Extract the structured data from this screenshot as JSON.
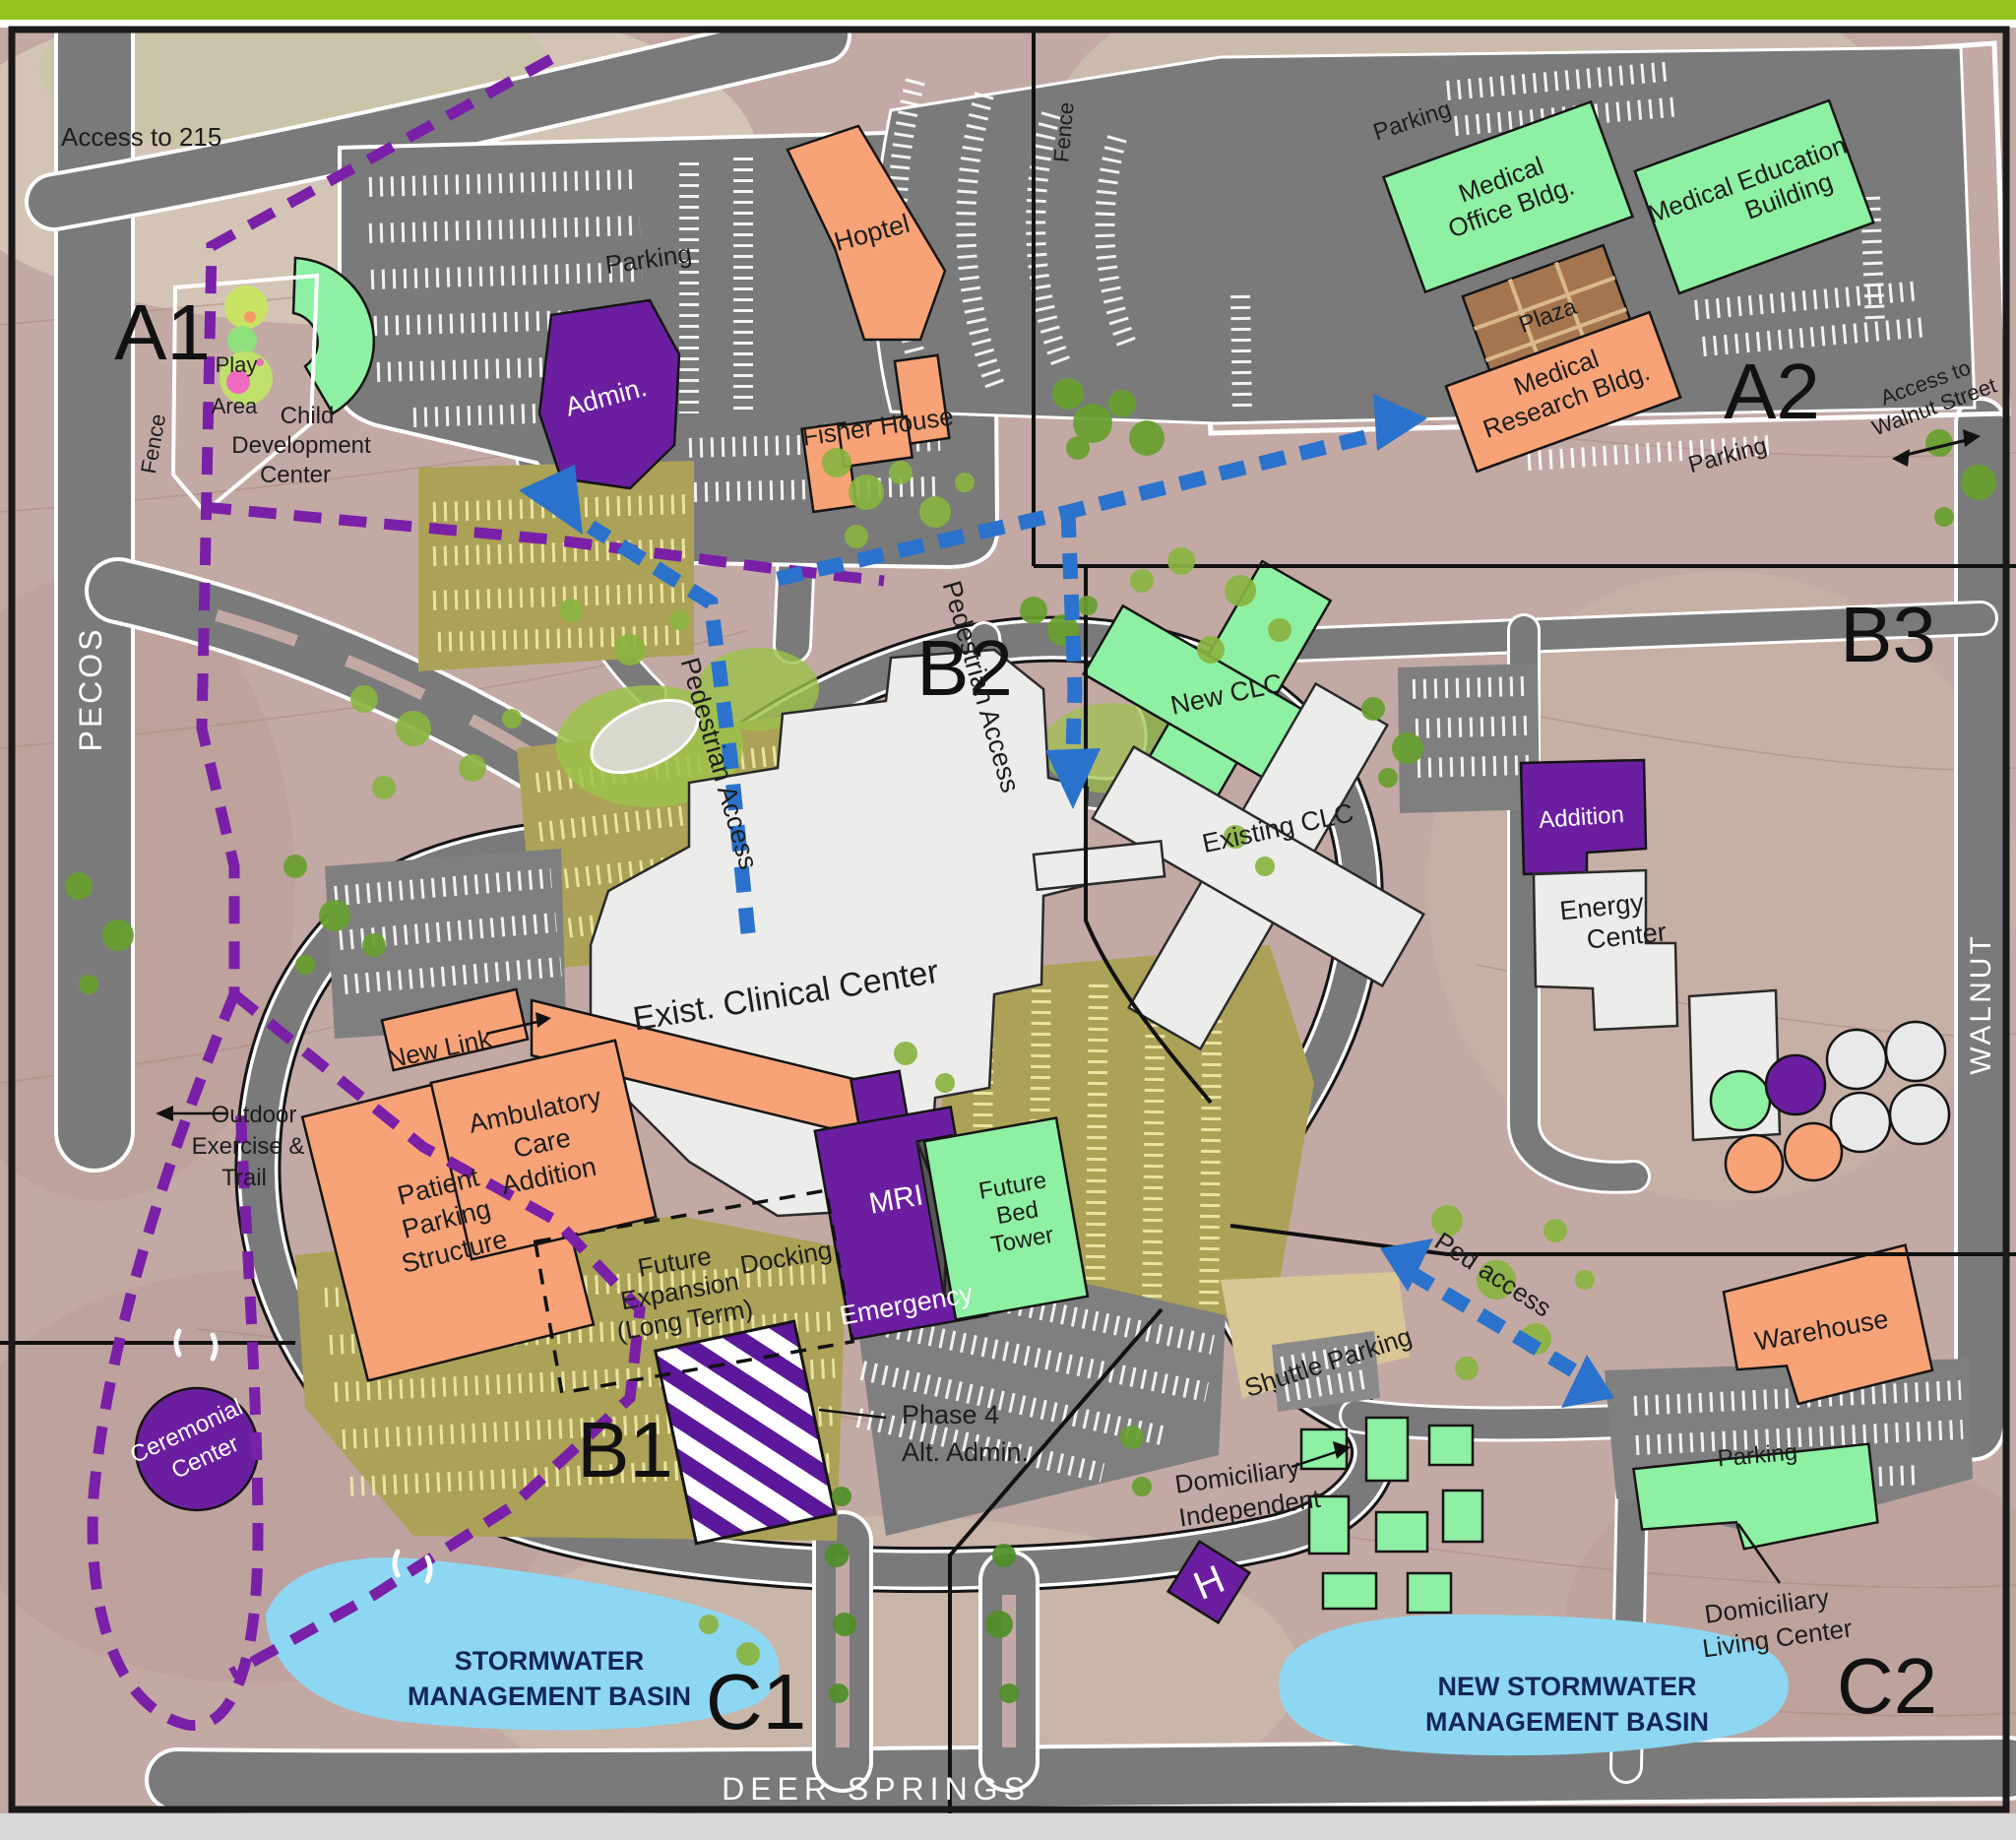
{
  "sections": {
    "a1": "A1",
    "a2": "A2",
    "b1": "B1",
    "b2": "B2",
    "b3": "B3",
    "c1": "C1",
    "c2": "C2"
  },
  "streets": {
    "pecos": "PECOS",
    "walnut": "WALNUT",
    "deer_springs": "DEER  SPRINGS"
  },
  "labels": {
    "access_215": "Access to 215",
    "fence_a1": "Fence",
    "fence_a2": "Fence",
    "play_1": "Play",
    "play_2": "Area",
    "cdc_1": "Child",
    "cdc_2": "Development",
    "cdc_3": "Center",
    "admin": "Admin.",
    "parking_a1": "Parking",
    "parking_a2_top": "Parking",
    "parking_a2_bottom": "Parking",
    "parking_c2": "Parking",
    "hoptel": "Hoptel",
    "fisher_house": "Fisher House",
    "med_office_1": "Medical",
    "med_office_2": "Office Bldg.",
    "med_ed_1": "Medical Education",
    "med_ed_2": "Building",
    "plaza": "Plaza",
    "med_research_1": "Medical",
    "med_research_2": "Research  Bldg.",
    "access_walnut_1": "Access to",
    "access_walnut_2": "Walnut Street",
    "ped_access_a1": "Pedestrian Access",
    "ped_access_b2": "Pedestrian Access",
    "ped_access_c2": "Ped access",
    "new_clc": "New CLC",
    "existing_clc": "Existing CLC",
    "addition": "Addition",
    "energy_1": "Energy",
    "energy_2": "Center",
    "exist_clinical": "Exist. Clinical Center",
    "new_link": "New Link",
    "patient_1": "Patient",
    "patient_2": "Parking",
    "patient_3": "Structure",
    "amb_1": "Ambulatory",
    "amb_2": "Care",
    "amb_3": "Addition",
    "outdoor_1": "Outdoor",
    "outdoor_2": "Exercise &",
    "outdoor_3": "Trail",
    "mri": "MRI",
    "emergency": "Emergency",
    "bed_1": "Future",
    "bed_2": "Bed",
    "bed_3": "Tower",
    "fexp_1": "Future",
    "fexp_2": "Expansion",
    "fexp_3": "(Long Term)",
    "docking": "Docking",
    "phase4_1": "Phase 4",
    "phase4_2": "Alt. Admin.",
    "ceremonial_1": "Ceremonial",
    "ceremonial_2": "Center",
    "basin1_1": "STORMWATER",
    "basin1_2": "MANAGEMENT BASIN",
    "basin2_1": "NEW  STORMWATER",
    "basin2_2": "MANAGEMENT BASIN",
    "shuttle": "Shuttle Parking",
    "warehouse": "Warehouse",
    "dom_ind_1": "Domiciliary",
    "dom_ind_2": "Independent",
    "dom_liv_1": "Domiciliary",
    "dom_liv_2": "Living Center",
    "helipad": "H"
  },
  "colors": {
    "existing_building": "#ececea",
    "new_building_green": "#8ef0a2",
    "proposed_orange": "#f7a377",
    "purple": "#6b1fa0",
    "parking_olive": "#aba257",
    "water": "#8ed7f2",
    "road": "#7a7a7a",
    "trail_purple": "#7a1fa8",
    "arrow_blue": "#2a72cc",
    "terrain": "#c3a9a4",
    "frame_green": "#96c41e"
  }
}
